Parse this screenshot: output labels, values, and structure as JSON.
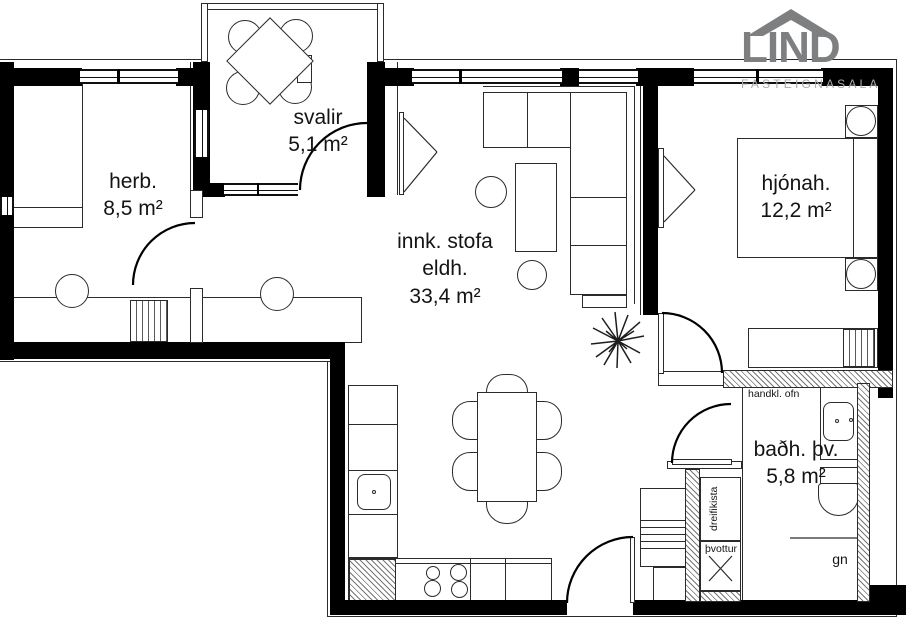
{
  "logo": {
    "name": "LIND",
    "tagline": "FASTEIGNASALA"
  },
  "rooms": {
    "herb": {
      "name": "herb.",
      "area": "8,5 m²"
    },
    "svalir": {
      "name": "svalir",
      "area": "5,1 m²"
    },
    "living": {
      "name_line1": "innk. stofa",
      "name_line2": "eldh.",
      "area": "33,4 m²"
    },
    "hjonah": {
      "name": "hjónah.",
      "area": "12,2 m²"
    },
    "bath": {
      "name": "baðh. þv.",
      "area": "5,8 m²"
    }
  },
  "annotations": {
    "towel_radiator": "handkl. ofn",
    "distribution_box": "dreifikista",
    "laundry": "þvottur",
    "shower": "gn"
  },
  "colors": {
    "wall": "#000000",
    "line": "#2b2b2b",
    "logo_gray": "#7d7f81",
    "logo_light": "#a8aaac"
  }
}
